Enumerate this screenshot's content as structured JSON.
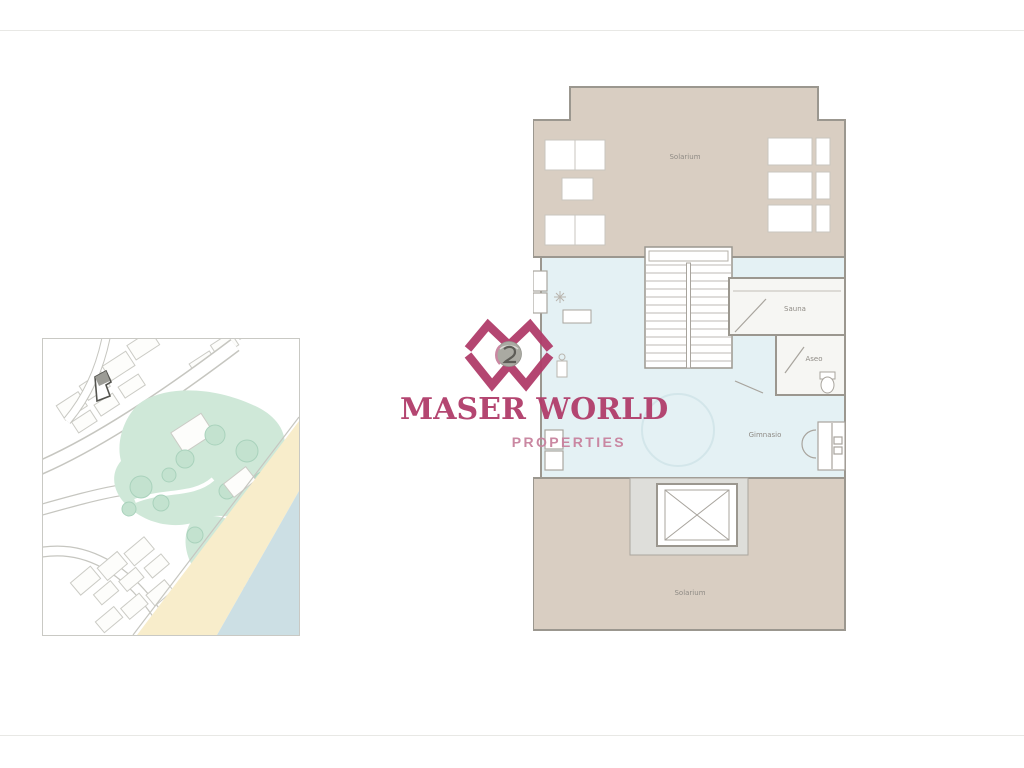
{
  "logo": {
    "name": "MASER WORLD",
    "subtitle": "PROPERTIES",
    "monogram_icon": "mw-globe-monogram"
  },
  "floor_plan": {
    "rooms": {
      "top_terrace_label": "Solarium",
      "sauna_label": "Sauna",
      "toilet_label": "Aseo",
      "gym_label": "Gimnasio",
      "bottom_terrace_label": "Solarium"
    }
  },
  "colors": {
    "brand_magenta": "#b13d6a",
    "brand_pink": "#c8829e",
    "terrace_beige": "#d9cec2",
    "interior_blue": "#e4f1f4",
    "wall_gray": "#9b978f",
    "room_white": "#f6f6f3",
    "lobby_gray": "#dededa",
    "label_gray": "#8f8b85",
    "map_green": "#cfe8d8",
    "map_tree": "#c3e2cf",
    "map_sand": "#f8edcb",
    "map_water": "#ccdfe4",
    "map_line": "#c6c6c0",
    "marker_dark": "#53534e",
    "marker_fill": "#9c9c96"
  }
}
